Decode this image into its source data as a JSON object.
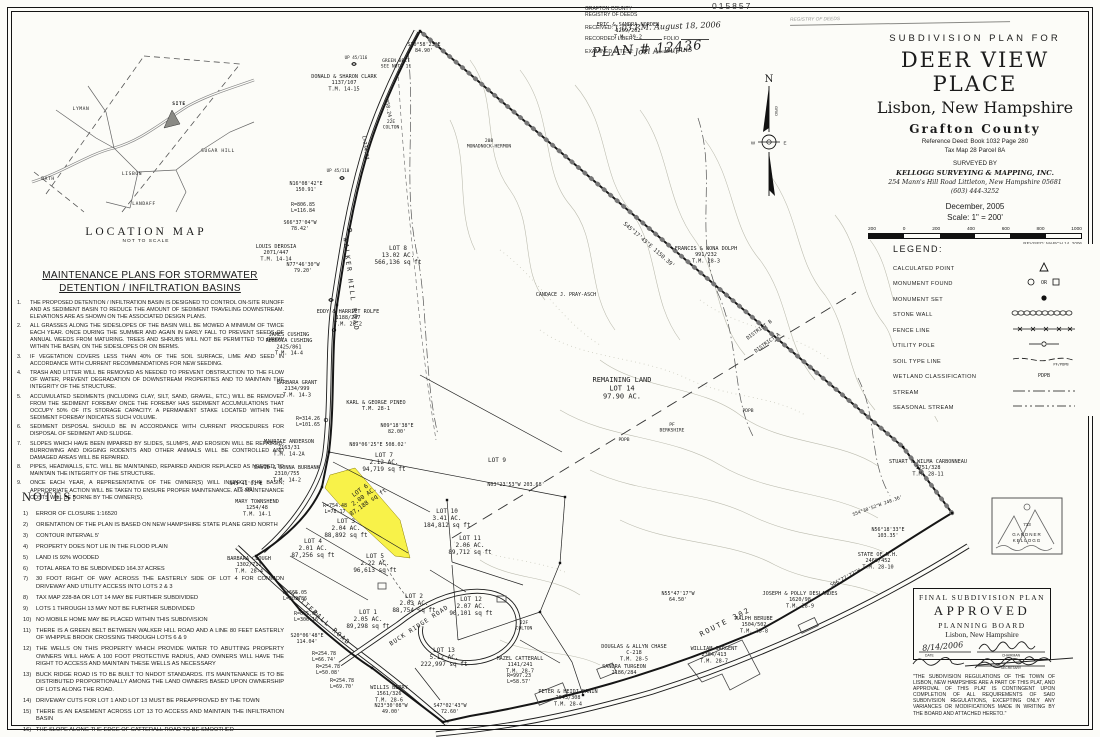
{
  "serial": "015857",
  "registry_stamp": {
    "agency1": "GRAFTON COUNTY",
    "agency2": "REGISTRY OF DEEDS",
    "received_label": "RECEIVED:",
    "received_value": "1:03 P.M. August 18, 2006",
    "recorded_label": "RECORDED: LIBER",
    "folio_label": "FOLIO",
    "attest_label": "EXAMINED ATTEST:",
    "attest_sig": "Joel A. Dupuis",
    "attest_sub": "REGISTRY",
    "plan_no": "PLAN # 12436"
  },
  "stamp2_text": "REGISTRY OF DEEDS",
  "location_map": {
    "title": "LOCATION MAP",
    "subtitle": "NOT TO SCALE",
    "towns": [
      {
        "t": "LYMAN",
        "x": 55,
        "y": 58
      },
      {
        "t": "SUGAR HILL",
        "x": 192,
        "y": 100
      },
      {
        "t": "BATH",
        "x": 22,
        "y": 128
      },
      {
        "t": "LISBON",
        "x": 106,
        "y": 123
      },
      {
        "t": "LANDAFF",
        "x": 118,
        "y": 153
      },
      {
        "t": "SITE",
        "x": 153,
        "y": 53
      }
    ]
  },
  "maintenance": {
    "title1": "MAINTENANCE PLANS FOR STORMWATER",
    "title2": "DETENTION / INFILTRATION BASINS",
    "items": [
      "THE PROPOSED DETENTION / INFILTRATION BASIN IS DESIGNED TO CONTROL ON-SITE RUNOFF AND AS SEDIMENT BASIN TO REDUCE THE AMOUNT OF SEDIMENT TRAVELING DOWNSTREAM.  ELEVATIONS ARE AS SHOWN ON THE ASSOCIATED DESIGN PLANS.",
      "ALL GRASSES ALONG THE SIDESLOPES OF THE BASIN WILL BE MOWED A MINIMUM OF TWICE EACH YEAR.  ONCE DURING THE SUMMER AND AGAIN IN EARLY FALL TO PREVENT SEEDS OF ANNUAL WEEDS FROM MATURING.  TREES AND SHRUBS WILL NOT BE PERMITTED TO GROW WITHIN THE BASIN, ON THE SIDESLOPES OR ON BERMS.",
      "IF VEGETATION COVERS LESS THAN 40% OF THE SOIL SURFACE, LIME AND SEED IN ACCORDANCE WITH CURRENT RECOMMENDATIONS FOR NEW SEEDING.",
      "TRASH AND LITTER WILL BE REMOVED AS NEEDED TO PREVENT OBSTRUCTION TO THE FLOW OF WATER, PREVENT DEGRADATION OF DOWNSTREAM PROPERTIES AND TO MAINTAIN THE INTEGRITY OF THE STRUCTURE.",
      "ACCUMULATED SEDIMENTS (INCLUDING CLAY, SILT, SAND, GRAVEL, ETC.) WILL BE REMOVED FROM THE SEDIMENT FOREBAY ONCE THE FOREBAY HAS SEDIMENT ACCUMULATIONS THAT OCCUPY 50% OF ITS STORAGE CAPACITY.  A PERMANENT STAKE LOCATED WITHIN THE SEDIMENT FOREBAY INDICATES SUCH VOLUME.",
      "SEDIMENT DISPOSAL SHOULD BE IN ACCORDANCE WITH CURRENT PROCEDURES FOR DISPOSAL OF SEDIMENT AND SLUDGE.",
      "SLOPES WHICH HAVE BEEN IMPAIRED BY SLIDES, SLUMPS, AND EROSION WILL BE REPAIRED.  BURROWING AND DIGGING RODENTS AND OTHER ANIMALS WILL BE CONTROLLED AND DAMAGED AREAS WILL BE REPAIRED.",
      "PIPES, HEADWALLS, ETC. WILL BE MAINTAINED, REPAIRED AND/OR REPLACED AS NEEDED TO MAINTAIN THE INTEGRITY OF THE STRUCTURE.",
      "ONCE EACH YEAR, A REPRESENTATIVE OF THE OWNER(S) WILL INSPECT THE BASIN; APPROPRIATE ACTION WILL BE TAKEN TO ENSURE PROPER MAINTENANCE.  ALL MAINTENANCE COSTS WILL BE BORNE BY THE OWNER(S)."
    ]
  },
  "notes": {
    "title": "NOTES:",
    "items": [
      "ERROR OF CLOSURE 1:16520",
      "ORIENTATION OF THE PLAN IS BASED ON NEW HAMPSHIRE STATE PLANE GRID NORTH",
      "CONTOUR INTERVAL 5'",
      "PROPERTY DOES NOT LIE IN THE FLOOD PLAIN",
      "LAND IS 92% WOODED",
      "TOTAL AREA TO BE SUBDIVIDED 164.37 ACRES",
      "30 FOOT RIGHT OF WAY ACROSS THE EASTERLY SIDE OF LOT 4 FOR COMMON DRIVEWAY AND UTILITY ACCESS INTO LOTS 2 & 3",
      "TAX MAP 228-8A OR LOT 14 MAY BE FURTHER SUBDIVIDED",
      "LOTS 1 THROUGH 13 MAY NOT BE FURTHER SUBDIVIDED",
      "NO MOBILE HOME MAY BE PLACED WITHIN THIS SUBDIVISION",
      "THERE IS A GREEN BELT BETWEEN WALKER HILL ROAD AND A LINE 80 FEET EASTERLY OF WHIPPLE BROOK CROSSING THROUGH LOTS 6 & 9",
      "THE WELLS ON THIS PROPERTY WHICH PROVIDE WATER TO ABUTTING PROPERTY OWNERS WILL HAVE A 100 FOOT PROTECTIVE RADIUS, AND OWNERS WILL HAVE THE RIGHT TO ACCESS AND MAINTAIN THESE WELLS AS NECESSARY",
      "BUCK RIDGE ROAD IS TO BE BUILT TO NHDOT STANDARDS. ITS MAINTENANCE IS TO BE DISTRIBUTED PROPORTIONALLY AMONG THE LAND OWNERS BASED UPON OWNERSHIP OF LOTS ALONG THE ROAD.",
      "DRIVEWAY CUTS FOR LOT 1 AND LOT 13 MUST BE PREAPPROVED BY THE TOWN",
      "THERE IS AN EASEMENT ACROSS LOT 13 TO ACCESS AND MAINTAIN THE INFILTRATION BASIN",
      "THE SLOPE ALONG THE EDGE OF CATTERALL ROAD TO BE SMOOTHED",
      "NAME & ADDRESS OF OWNER:"
    ],
    "owner_lines": [
      "JAMES W. POWERS INC",
      "P.O. BOX 10084",
      "BEDFORD, N.H.  03110"
    ]
  },
  "title_block": {
    "kicker": "SUBDIVISION PLAN FOR",
    "title": "DEER VIEW PLACE",
    "subtitle": "Lisbon, New Hampshire",
    "county": "Grafton   County",
    "deed": "Reference Deed:  Book 1032   Page 280",
    "tax": "Tax Map 28      Parcel 8A",
    "surveyed_by": "SURVEYED BY",
    "surveyor": "KELLOGG SURVEYING & MAPPING, INC.",
    "address": "254 Mann's Hill Road      Littleton, New Hampshire 05681",
    "phone": "(603) 444-3252",
    "date": "December, 2005",
    "scale": "Scale:  1\" = 200'",
    "scalebar_labels": [
      "200",
      "0",
      "200",
      "400",
      "600",
      "800",
      "1000"
    ],
    "revision": "REVISED: MARCH 14, 2006"
  },
  "legend": {
    "title": "LEGEND:",
    "items": [
      {
        "label": "CALCULATED POINT",
        "sym": "calc"
      },
      {
        "label": "MONUMENT FOUND",
        "sym": "monfound"
      },
      {
        "label": "MONUMENT SET",
        "sym": "monset"
      },
      {
        "label": "STONE WALL",
        "sym": "stonewall"
      },
      {
        "label": "FENCE LINE",
        "sym": "fence"
      },
      {
        "label": "UTILITY POLE",
        "sym": "utility"
      },
      {
        "label": "SOIL TYPE LINE",
        "sym": "soil"
      },
      {
        "label": "WETLAND CLASSIFICATION",
        "sym": "wetland"
      },
      {
        "label": "STREAM",
        "sym": "stream"
      },
      {
        "label": "SEASONAL STREAM",
        "sym": "seasonal"
      }
    ]
  },
  "north_arrow": {
    "n": "N",
    "w": "W",
    "e": "E",
    "grid": "GRID"
  },
  "approval": {
    "line1": "FINAL SUBDIVISION PLAN",
    "line2": "APPROVED",
    "line3": "PLANNING BOARD",
    "line4": "Lisbon, New Hampshire",
    "date": "8/14/2006",
    "date_caption": "DATE",
    "sig_caption1": "CHAIRMAN",
    "sig_caption2": "SECRETARY",
    "disclaimer": "\"THE SUBDIVISION REGULATIONS OF THE TOWN OF LISBON, NEW HAMPSHIRE ARE A PART OF THIS PLAT, AND APPROVAL OF THIS PLAT IS CONTINGENT UPON COMPLETION OF ALL REQUIREMENTS OF SAID SUBDIVISION REGULATIONS, EXCEPTING ONLY ANY VARIANCES OR MODIFICATIONS MADE IN WRITING BY THE BOARD AND ATTACHED HERETO.\""
  },
  "seal": {
    "number": "733",
    "line1": "GARDNER",
    "line2": "KELLOGG"
  },
  "map": {
    "labels": [
      {
        "l": [
          "ERIC & SANDRA NORDEN",
          "1209/202",
          "T.M. 39-2"
        ],
        "x": 628,
        "y": 26,
        "s": 5.2
      },
      {
        "l": [
          "DONALD & SHARON CLARK",
          "1137/107",
          "T.M. 14-15"
        ],
        "x": 344,
        "y": 78,
        "s": 5.2
      },
      {
        "l": [
          "LOUIS DEROSIA",
          "2071/447",
          "T.M. 14-14"
        ],
        "x": 276,
        "y": 248,
        "s": 5.2
      },
      {
        "l": [
          "EDDY & HARRIET ROLFE",
          "1188/287",
          "T.M. 28-2"
        ],
        "x": 348,
        "y": 313,
        "s": 5.2
      },
      {
        "l": [
          "JAMES CUSHING",
          "REBECCA CUSHING",
          "2425/861",
          "T.M. 14-4"
        ],
        "x": 289,
        "y": 336,
        "s": 5.2
      },
      {
        "l": [
          "BARBARA GRANT",
          "2134/999",
          "T.M. 14-3"
        ],
        "x": 297,
        "y": 384,
        "s": 5.2
      },
      {
        "l": [
          "KARL & GEORGE PINEO",
          "T.M. 28-1"
        ],
        "x": 376,
        "y": 404,
        "s": 5.2
      },
      {
        "l": [
          "MAURICE ANDERSON",
          "2163/31",
          "T.M. 14-2A"
        ],
        "x": 289,
        "y": 443,
        "s": 5.2
      },
      {
        "l": [
          "DAVID & DONNA BURBANK",
          "2310/755",
          "T.M. 14-2"
        ],
        "x": 287,
        "y": 469,
        "s": 5.2
      },
      {
        "l": [
          "MARY TOWNSHEND",
          "1254/48",
          "T.M. 14-1"
        ],
        "x": 257,
        "y": 503,
        "s": 5.2
      },
      {
        "l": [
          "BARBARA CLOUGH",
          "1302/711",
          "T.M. 28-4"
        ],
        "x": 249,
        "y": 560,
        "s": 5.2
      },
      {
        "l": [
          "FRANCIS & NONA DOLPH",
          "991/232",
          "T.M. 28-3"
        ],
        "x": 706,
        "y": 250,
        "s": 5.2
      },
      {
        "l": [
          "STUART & WILMA CARBONNEAU",
          "1751/328",
          "T.M. 28-11"
        ],
        "x": 928,
        "y": 463,
        "s": 5.2
      },
      {
        "l": [
          "STATE OF N.H.",
          "2460/452",
          "T.M. 28-10"
        ],
        "x": 878,
        "y": 556,
        "s": 5.2
      },
      {
        "l": [
          "JOSEPH & POLLY DESLANDES",
          "1620/98",
          "T.M. 28-9"
        ],
        "x": 800,
        "y": 595,
        "s": 5.2
      },
      {
        "l": [
          "RALPH BERUBE",
          "1504/502",
          "T.M. 28-8"
        ],
        "x": 754,
        "y": 620,
        "s": 5.2
      },
      {
        "l": [
          "WILLIAM SARGENT",
          "2384/413",
          "T.M. 28-7"
        ],
        "x": 714,
        "y": 650,
        "s": 5.2
      },
      {
        "l": [
          "DOUGLAS & ALLYN CHASE",
          "C-218",
          "T.M. 28-5"
        ],
        "x": 634,
        "y": 648,
        "s": 5.2
      },
      {
        "l": [
          "SANDRA TURGEON",
          "2186/284"
        ],
        "x": 624,
        "y": 668,
        "s": 5.2
      },
      {
        "l": [
          "PETER & HEIDI DANIN",
          "2043/308",
          "T.M. 28-4"
        ],
        "x": 568,
        "y": 693,
        "s": 5.2
      },
      {
        "l": [
          "HAZEL CATTERALL",
          "1141/241",
          "T.M. 28-7"
        ],
        "x": 520,
        "y": 660,
        "s": 5.2
      },
      {
        "l": [
          "WILLIS BERRY",
          "1561/326",
          "T.M. 28-6"
        ],
        "x": 389,
        "y": 689,
        "s": 5.2
      },
      {
        "l": [
          "CANDACE J. PRAY-ASCH"
        ],
        "x": 566,
        "y": 296,
        "s": 5
      },
      {
        "l": [
          "LOT 8",
          "13.02 AC.",
          "566,136 sq ft"
        ],
        "x": 398,
        "y": 250,
        "s": 6
      },
      {
        "l": [
          "LOT 7",
          "2.12 AC.",
          "94,719 sq ft"
        ],
        "x": 384,
        "y": 457,
        "s": 6
      },
      {
        "l": [
          "LOT 6",
          "2.00 AC.",
          "87,188 sq ft"
        ],
        "x": 361,
        "y": 492,
        "s": 6,
        "r": -35
      },
      {
        "l": [
          "LOT 3",
          "2.04 AC.",
          "88,892 sq ft"
        ],
        "x": 346,
        "y": 523,
        "s": 6
      },
      {
        "l": [
          "LOT 4",
          "2.01 AC.",
          "87,256 sq ft"
        ],
        "x": 313,
        "y": 543,
        "s": 6
      },
      {
        "l": [
          "LOT 5",
          "2.22 AC.",
          "96,613 sq ft"
        ],
        "x": 375,
        "y": 558,
        "s": 6
      },
      {
        "l": [
          "LOT 9"
        ],
        "x": 497,
        "y": 462,
        "s": 6
      },
      {
        "l": [
          "LOT 10",
          "3.41 AC.",
          "184,812 sq ft"
        ],
        "x": 447,
        "y": 513,
        "s": 6
      },
      {
        "l": [
          "LOT 11",
          "2.06 AC.",
          "89,712 sq ft"
        ],
        "x": 470,
        "y": 540,
        "s": 6
      },
      {
        "l": [
          "LOT 12",
          "2.07 AC.",
          "90,101 sq ft"
        ],
        "x": 471,
        "y": 601,
        "s": 6
      },
      {
        "l": [
          "LOT 13",
          "5.12 AC.",
          "222,997 sq ft"
        ],
        "x": 444,
        "y": 652,
        "s": 6
      },
      {
        "l": [
          "LOT 1",
          "2.05 AC.",
          "89,298 sq ft"
        ],
        "x": 368,
        "y": 614,
        "s": 6
      },
      {
        "l": [
          "LOT 2",
          "2.03 AC.",
          "88,754 sq ft"
        ],
        "x": 414,
        "y": 598,
        "s": 6
      },
      {
        "l": [
          "REMAINING LAND",
          "LOT 14",
          "97.90 AC."
        ],
        "x": 622,
        "y": 382,
        "s": 7
      },
      {
        "l": [
          "WALKER HILL ROAD"
        ],
        "x": 349,
        "y": 285,
        "s": 6.5,
        "r": 83,
        "sp": 2
      },
      {
        "l": [
          "CATTERALL ROAD"
        ],
        "x": 320,
        "y": 620,
        "s": 6.5,
        "r": 42,
        "sp": 1.5
      },
      {
        "l": [
          "BUCK RIDGE ROAD"
        ],
        "x": 420,
        "y": 627,
        "s": 6,
        "r": -33,
        "sp": 1
      },
      {
        "l": [
          "ROUTE 302"
        ],
        "x": 726,
        "y": 624,
        "s": 7,
        "r": -27,
        "sp": 2
      },
      {
        "l": [
          "N16°08'42\"E",
          "150.91'"
        ],
        "x": 306,
        "y": 185,
        "s": 5
      },
      {
        "l": [
          "R=806.85",
          "L=116.84"
        ],
        "x": 303,
        "y": 206,
        "s": 5
      },
      {
        "l": [
          "S66°37'04\"W",
          "78.42'"
        ],
        "x": 300,
        "y": 224,
        "s": 5
      },
      {
        "l": [
          "N77°46'30\"W",
          "79.20'"
        ],
        "x": 303,
        "y": 266,
        "s": 5
      },
      {
        "l": [
          "S70°58'23\"E",
          "84.90'"
        ],
        "x": 424,
        "y": 46,
        "s": 5
      },
      {
        "l": [
          "GREEN BELT",
          "SEE NOTE 11"
        ],
        "x": 396,
        "y": 62,
        "s": 4.6
      },
      {
        "l": [
          "S45°17'43\"E   1150.39'"
        ],
        "x": 648,
        "y": 246,
        "s": 5.5,
        "r": 41
      },
      {
        "l": [
          "R=314.26",
          "L=101.65"
        ],
        "x": 308,
        "y": 420,
        "s": 5
      },
      {
        "l": [
          "N09°18'38\"E",
          "82.00'"
        ],
        "x": 397,
        "y": 427,
        "s": 5
      },
      {
        "l": [
          "N89°06'25\"E  508.02'"
        ],
        "x": 378,
        "y": 446,
        "s": 5
      },
      {
        "l": [
          "N45°41'01\"E",
          "75.00'"
        ],
        "x": 246,
        "y": 485,
        "s": 5
      },
      {
        "l": [
          "R=754.48",
          "L=78.17"
        ],
        "x": 335,
        "y": 507,
        "s": 5
      },
      {
        "l": [
          "R=665.05",
          "L=203.86"
        ],
        "x": 295,
        "y": 594,
        "s": 5
      },
      {
        "l": [
          "R=665.05",
          "L=306.16"
        ],
        "x": 306,
        "y": 615,
        "s": 5
      },
      {
        "l": [
          "S20°06'48\"E",
          "114.04'"
        ],
        "x": 307,
        "y": 637,
        "s": 5
      },
      {
        "l": [
          "R=254.78",
          "L=66.74'"
        ],
        "x": 324,
        "y": 655,
        "s": 5
      },
      {
        "l": [
          "R=254.78",
          "L=50.08'"
        ],
        "x": 328,
        "y": 668,
        "s": 5
      },
      {
        "l": [
          "R=254.78",
          "L=69.70'"
        ],
        "x": 342,
        "y": 682,
        "s": 5
      },
      {
        "l": [
          "N23°30'08\"W",
          "49.00'"
        ],
        "x": 391,
        "y": 707,
        "s": 5
      },
      {
        "l": [
          "S47°02'43\"W",
          "72.60'"
        ],
        "x": 450,
        "y": 707,
        "s": 5
      },
      {
        "l": [
          "R=997.23",
          "L=58.57'"
        ],
        "x": 519,
        "y": 677,
        "s": 5
      },
      {
        "l": [
          "N55°47'17\"W",
          "64.50'"
        ],
        "x": 678,
        "y": 595,
        "s": 5
      },
      {
        "l": [
          "N03°23'53\"W 203.68'"
        ],
        "x": 516,
        "y": 486,
        "s": 5
      },
      {
        "l": [
          "DISTRICT B"
        ],
        "x": 760,
        "y": 331,
        "s": 5,
        "r": -36
      },
      {
        "l": [
          "DISTRICT A"
        ],
        "x": 768,
        "y": 344,
        "s": 5,
        "r": -36
      },
      {
        "l": [
          "N56°18'33\"E",
          "103.35'"
        ],
        "x": 888,
        "y": 531,
        "s": 5
      },
      {
        "l": [
          "S66°27'27\"W"
        ],
        "x": 846,
        "y": 579,
        "s": 5,
        "r": -28
      },
      {
        "l": [
          "S54°30'52\"W  248.36'"
        ],
        "x": 878,
        "y": 507,
        "s": 4.6,
        "r": -20
      },
      {
        "l": [
          "22E",
          "COLTON"
        ],
        "x": 391,
        "y": 123,
        "s": 4.6
      },
      {
        "l": [
          "208",
          "MONADNOCK-HERMON"
        ],
        "x": 489,
        "y": 142,
        "s": 4.6
      },
      {
        "l": [
          "22F",
          "COLTON"
        ],
        "x": 524,
        "y": 624,
        "s": 4.6
      },
      {
        "l": [
          "PF",
          "BERKSHIRE"
        ],
        "x": 672,
        "y": 426,
        "s": 4.6
      },
      {
        "l": [
          "PDPB"
        ],
        "x": 748,
        "y": 412,
        "s": 4.6
      },
      {
        "l": [
          "PDPB"
        ],
        "x": 624,
        "y": 441,
        "s": 4.6
      },
      {
        "l": [
          "UP 45/116"
        ],
        "x": 356,
        "y": 59,
        "s": 4.2
      },
      {
        "l": [
          "UP 45/110"
        ],
        "x": 338,
        "y": 172,
        "s": 4.2
      },
      {
        "l": [
          "358.24'"
        ],
        "x": 387,
        "y": 110,
        "s": 5,
        "r": 80
      },
      {
        "l": [
          "L=234.27"
        ],
        "x": 364,
        "y": 148,
        "s": 5,
        "r": 82
      }
    ]
  }
}
